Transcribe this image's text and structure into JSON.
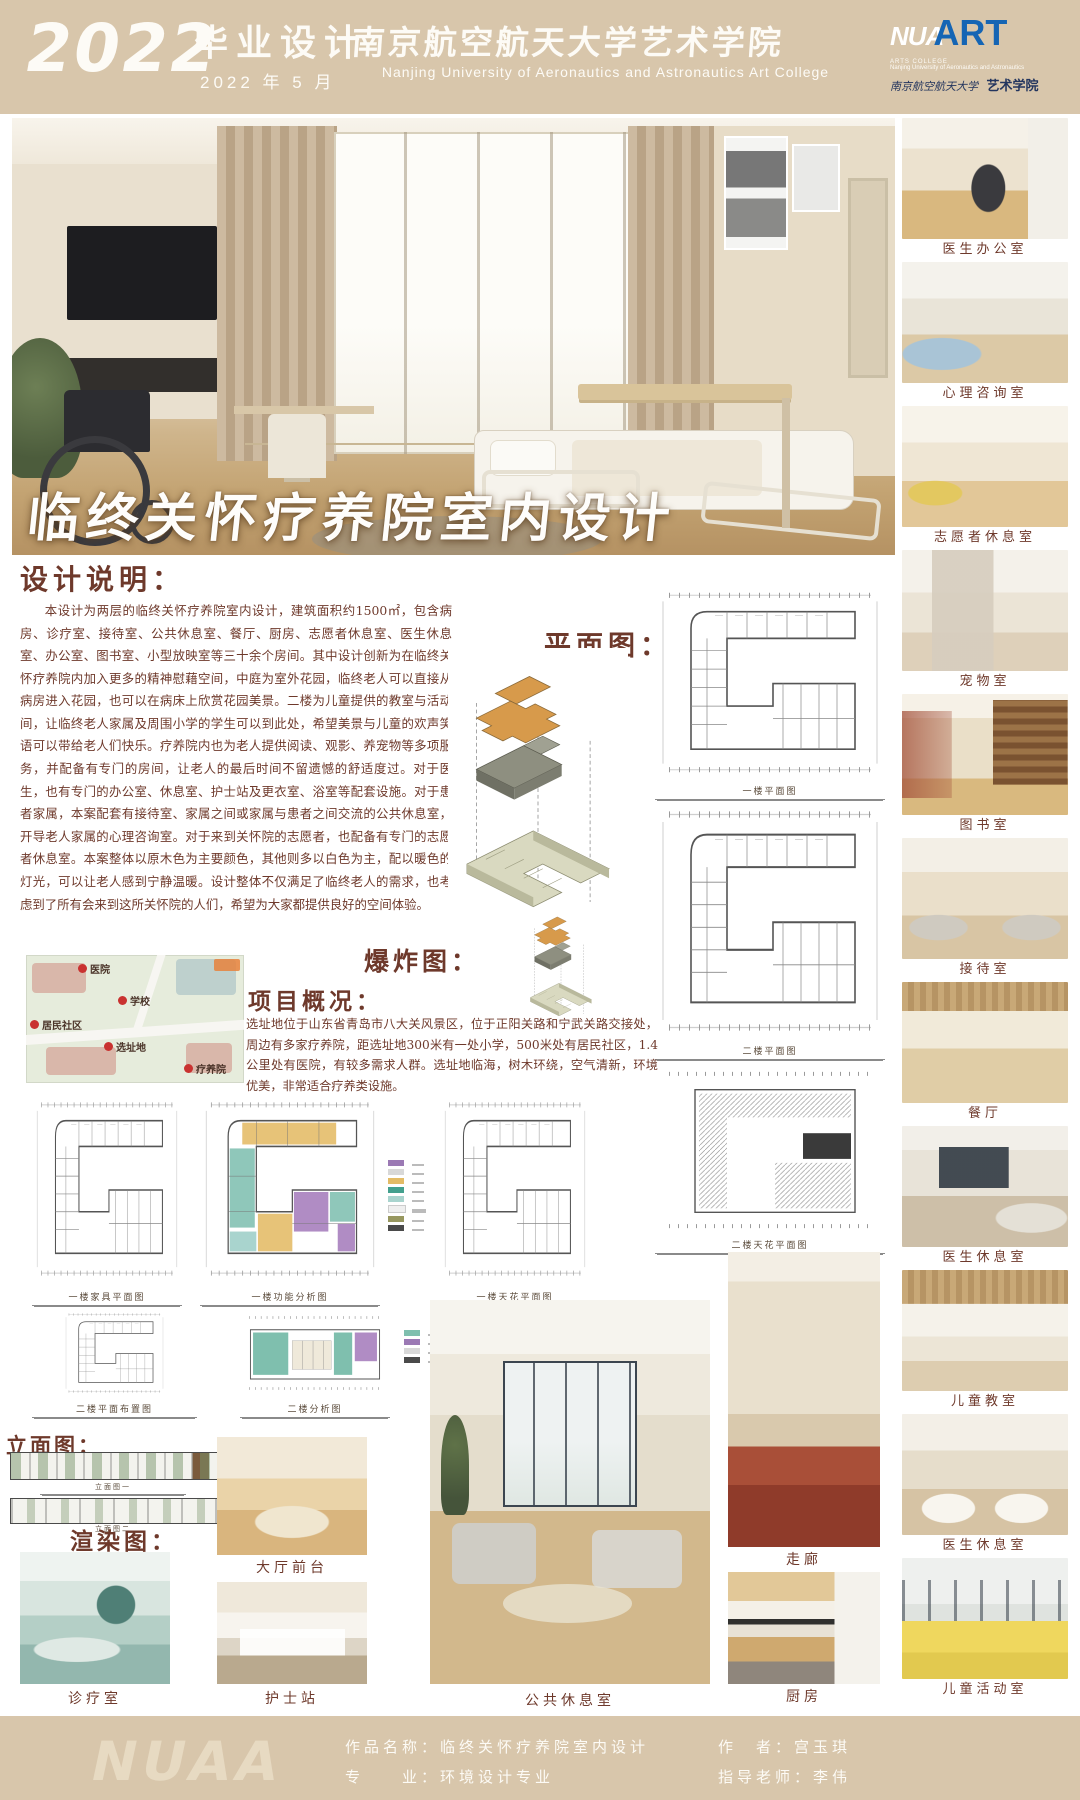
{
  "colors": {
    "band_tan": "#d8c6ab",
    "ink_maroon": "#6e392b",
    "logo_blue": "#1565b4",
    "title_white": "#fefdfb"
  },
  "header": {
    "year": "2022",
    "program": "毕业设计",
    "date": "2022 年 5 月",
    "school_cn": "南京航空航天大学艺术学院",
    "school_en": "Nanjing University of Aeronautics and Astronautics Art College",
    "logo": {
      "nu": "NUA",
      "art": "ART",
      "line1": "ARTS COLLEGE",
      "line2": "Nanjing University of Aeronautics and Astronautics",
      "seal_cn": "南京航空航天大学",
      "seal_art": "艺术学院"
    }
  },
  "hero": {
    "title": "临终关怀疗养院室内设计"
  },
  "design_note": {
    "heading": "设计说明：",
    "body": "本设计为两层的临终关怀疗养院室内设计，建筑面积约1500㎡，包含病房、诊疗室、接待室、公共休息室、餐厅、厨房、志愿者休息室、医生休息室、办公室、图书室、小型放映室等三十余个房间。其中设计创新为在临终关怀疗养院内加入更多的精神慰藉空间，中庭为室外花园，临终老人可以直接从病房进入花园，也可以在病床上欣赏花园美景。二楼为儿童提供的教室与活动间，让临终老人家属及周围小学的学生可以到此处，希望美景与儿童的欢声笑语可以带给老人们快乐。疗养院内也为老人提供阅读、观影、养宠物等多项服务，并配备有专门的房间，让老人的最后时间不留遗憾的舒适度过。对于医生，也有专门的办公室、休息室、护士站及更衣室、浴室等配套设施。对于患者家属，本案配套有接待室、家属之间或家属与患者之间交流的公共休息室，开导老人家属的心理咨询室。对于来到关怀院的志愿者，也配备有专门的志愿者休息室。本案整体以原木色为主要颜色，其他则多以白色为主，配以暖色的灯光，可以让老人感到宁静温暖。设计整体不仅满足了临终老人的需求，也考虑到了所有会来到这所关怀院的人们，希望为大家都提供良好的空间体验。"
  },
  "project": {
    "heading": "项目概况：",
    "body": "选址地位于山东省青岛市八大关风景区，位于正阳关路和宁武关路交接处，周边有多家疗养院，距选址地300米有一处小学，500米处有居民社区，1.4公里处有医院，有较多需求人群。选址地临海，树木环绕，空气清新，环境优美，非常适合疗养类设施。"
  },
  "labels": {
    "plan": "平面图：",
    "explode": "爆炸图：",
    "elevation": "立面图：",
    "render": "渲染图："
  },
  "map": {
    "hospital": "医院",
    "school": "学校",
    "community": "居民社区",
    "site": "选址地",
    "nursing": "疗养院"
  },
  "plans": {
    "captions": {
      "a": "一楼平面图",
      "b": "二楼平面图",
      "c": "二楼天花平面图",
      "r1": [
        {
          "t": "一楼家具平面图"
        },
        {
          "t": "一楼功能分析图"
        },
        {
          "t": "一楼天花平面图"
        }
      ],
      "r2": [
        {
          "t": "二楼平面布置图"
        },
        {
          "t": "二楼分析图"
        }
      ],
      "e1": "立面图一",
      "e2": "立面图二"
    },
    "zoning_legend_colors": [
      "#9b79b4",
      "#d8d8d8",
      "#e3bb66",
      "#43a08e",
      "#a9d4ce",
      "#efefef",
      "#97975f",
      "#4a4a4a"
    ],
    "zoning_legend_colors_2": [
      "#7fbfae",
      "#9b79b4",
      "#d8d8d8",
      "#4a4a4a"
    ]
  },
  "sidebar": {
    "items": [
      {
        "label": "医生办公室"
      },
      {
        "label": "心理咨询室"
      },
      {
        "label": "志愿者休息室"
      },
      {
        "label": "宠物室"
      },
      {
        "label": "图书室"
      },
      {
        "label": "接待室"
      },
      {
        "label": "餐厅"
      },
      {
        "label": "医生休息室"
      },
      {
        "label": "儿童教室"
      },
      {
        "label": "医生休息室"
      },
      {
        "label": "儿童活动室"
      }
    ]
  },
  "bottom": {
    "lobby": "大厅前台",
    "nurse": "护士站",
    "clinic": "诊疗室",
    "lounge": "公共休息室",
    "corridor": "走廊",
    "kitchen": "厨房"
  },
  "footer": {
    "watermark": "NUAA",
    "work": "作品名称：临终关怀疗养院室内设计",
    "major": "专　　业：环境设计专业",
    "author": "作　者：宫玉琪",
    "advisor": "指导老师：李伟"
  }
}
